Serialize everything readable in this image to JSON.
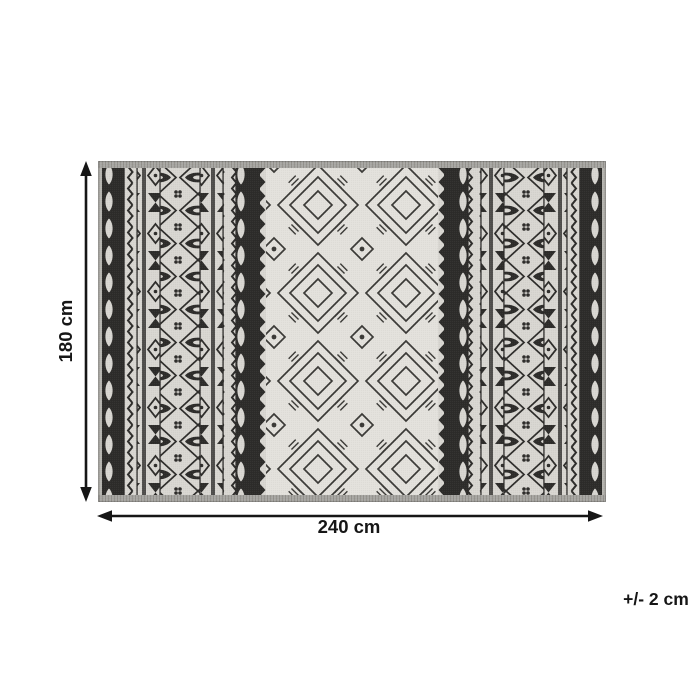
{
  "diagram": {
    "height_label": "180 cm",
    "width_label": "240 cm",
    "tolerance_label": "+/- 2 cm"
  },
  "colors": {
    "page_background": "#ffffff",
    "dimension_text": "#161616",
    "arrow": "#161616",
    "rug_dark": "#2d2c2a",
    "rug_light": "#d8d6d1",
    "rug_center_background": "#e3e1dc",
    "rug_binding_gray": "#a8a7a3",
    "rug_selvedge_gray": "#b6b5b0"
  }
}
